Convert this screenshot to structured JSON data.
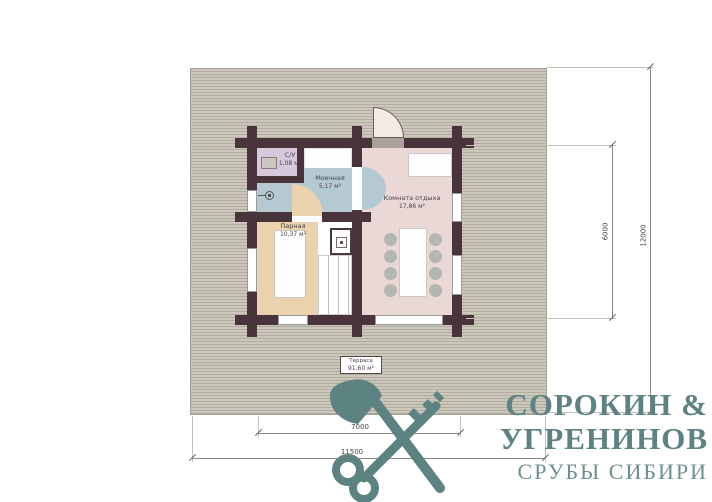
{
  "plan": {
    "rooms": {
      "su": {
        "name": "С/У",
        "area": "1,08 м²"
      },
      "washroom": {
        "name": "Моечная",
        "area": "5,17 м²"
      },
      "steam": {
        "name": "Парная",
        "area": "10,37 м²"
      },
      "lounge": {
        "name": "Комната отдыха",
        "area": "17,86 м²"
      },
      "terrace": {
        "name": "Терраса",
        "area": "91,60 м²"
      }
    },
    "dimensions": {
      "right_inner": "6000",
      "right_outer": "12000",
      "bottom_inner": "7000",
      "bottom_outer": "11500"
    }
  },
  "logo": {
    "line1": "СОРОКИН &",
    "line2": "УГРЕНИНОВ",
    "line3": "СРУБЫ СИБИРИ"
  },
  "colors": {
    "wall": "#48343a",
    "terrace_deck": "#c9c4b8",
    "room_su": "#d7c9db",
    "room_washroom": "#b5c9d3",
    "room_steam": "#e9d2ac",
    "room_lounge": "#ead8d6",
    "chair": "#b3b7af",
    "logo_teal": "#5d8282"
  }
}
